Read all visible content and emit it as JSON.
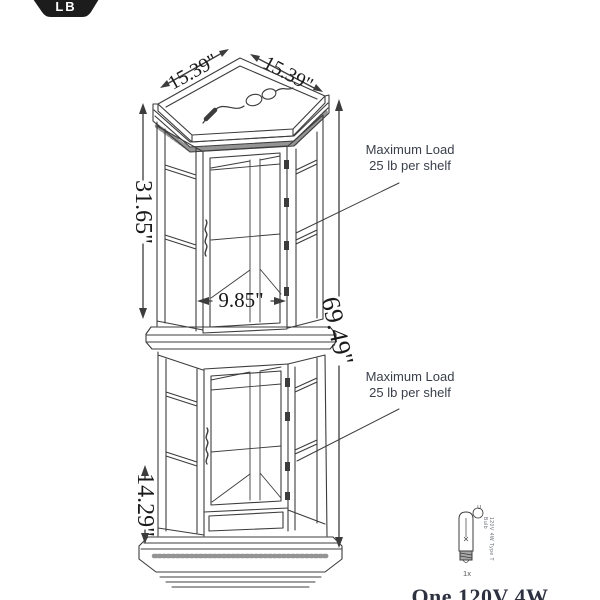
{
  "badge": {
    "label": "LB"
  },
  "dimensions": {
    "top_left_depth": "15.39\"",
    "top_right_depth": "15.39\"",
    "upper_section_height": "31.65\"",
    "inner_width": "9.85\"",
    "total_height": "69.49\"",
    "base_section_height": "14.29\""
  },
  "annotations": {
    "upper": {
      "line1": "Maximum Load",
      "line2": "25 lb per shelf"
    },
    "lower": {
      "line1": "Maximum Load",
      "line2": "25 lb per shelf"
    }
  },
  "bulb": {
    "cert_mark": "U",
    "spec": "120V 4W Type T Bulb",
    "quantity": "1x"
  },
  "caption": "One 120V 4W",
  "colors": {
    "line": "#3c3c3c",
    "badge_bg": "#1c1c1c",
    "text": "#1a1a1a",
    "annotation": "#3a3f4a",
    "caption": "#2e3140"
  }
}
